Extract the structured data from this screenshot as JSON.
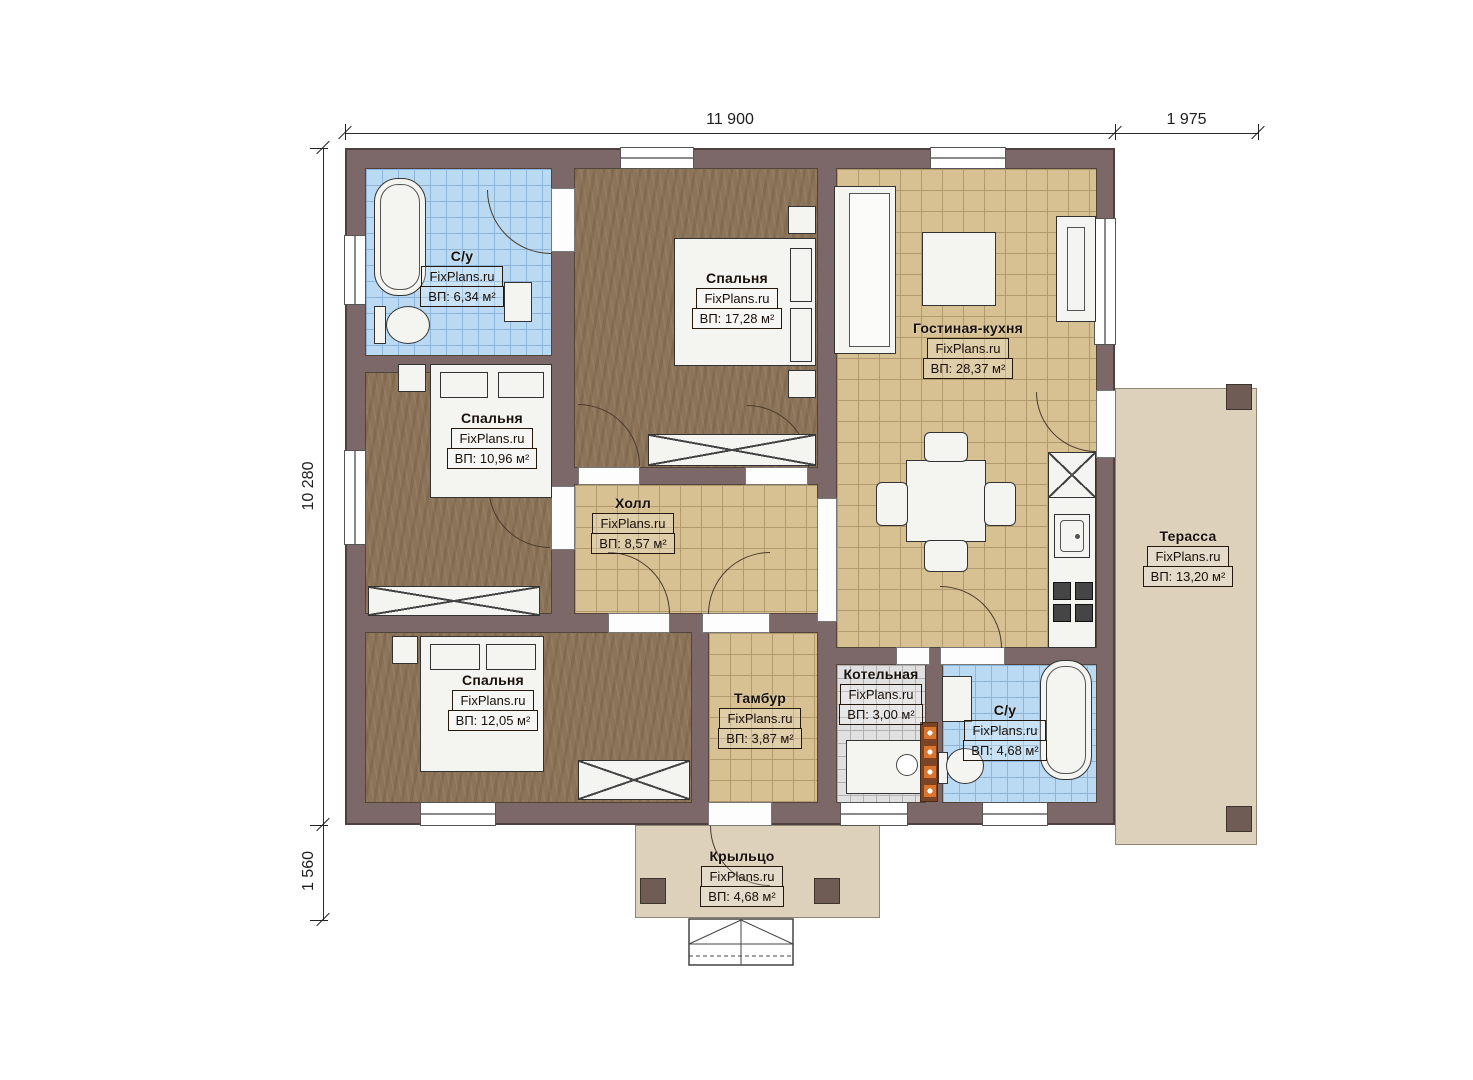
{
  "plan": {
    "brand": "FixPlans.ru",
    "dimensions": {
      "width_main": "11 900",
      "width_terrace": "1 975",
      "height_main": "10 280",
      "height_porch": "1 560"
    },
    "rooms": [
      {
        "key": "bathroom-top",
        "name": "С/у",
        "brand": "FixPlans.ru",
        "area": "ВП: 6,34 м²"
      },
      {
        "key": "bedroom-top",
        "name": "Спальня",
        "brand": "FixPlans.ru",
        "area": "ВП: 17,28 м²"
      },
      {
        "key": "living-kitchen",
        "name": "Гостиная-кухня",
        "brand": "FixPlans.ru",
        "area": "ВП: 28,37 м²"
      },
      {
        "key": "bedroom-middle",
        "name": "Спальня",
        "brand": "FixPlans.ru",
        "area": "ВП: 10,96 м²"
      },
      {
        "key": "hall",
        "name": "Холл",
        "brand": "FixPlans.ru",
        "area": "ВП: 8,57 м²"
      },
      {
        "key": "terrace",
        "name": "Терасса",
        "brand": "FixPlans.ru",
        "area": "ВП: 13,20 м²"
      },
      {
        "key": "bedroom-bottom",
        "name": "Спальня",
        "brand": "FixPlans.ru",
        "area": "ВП: 12,05 м²"
      },
      {
        "key": "tambour",
        "name": "Тамбур",
        "brand": "FixPlans.ru",
        "area": "ВП: 3,87 м²"
      },
      {
        "key": "boiler-room",
        "name": "Котельная",
        "brand": "FixPlans.ru",
        "area": "ВП: 3,00 м²"
      },
      {
        "key": "bathroom-bottom",
        "name": "С/у",
        "brand": "FixPlans.ru",
        "area": "ВП: 4,68 м²"
      },
      {
        "key": "porch",
        "name": "Крыльцо",
        "brand": "FixPlans.ru",
        "area": "ВП: 4,68 м²"
      }
    ],
    "colors": {
      "wall": "#7c6868",
      "wood_floor": "#8b7458",
      "tile_tan": "#d7c193",
      "tile_blue": "#badaf3",
      "tile_gray": "#e0e0e0",
      "outdoor": "#ddd1bc",
      "chimney_orange": "#d8752f"
    }
  }
}
